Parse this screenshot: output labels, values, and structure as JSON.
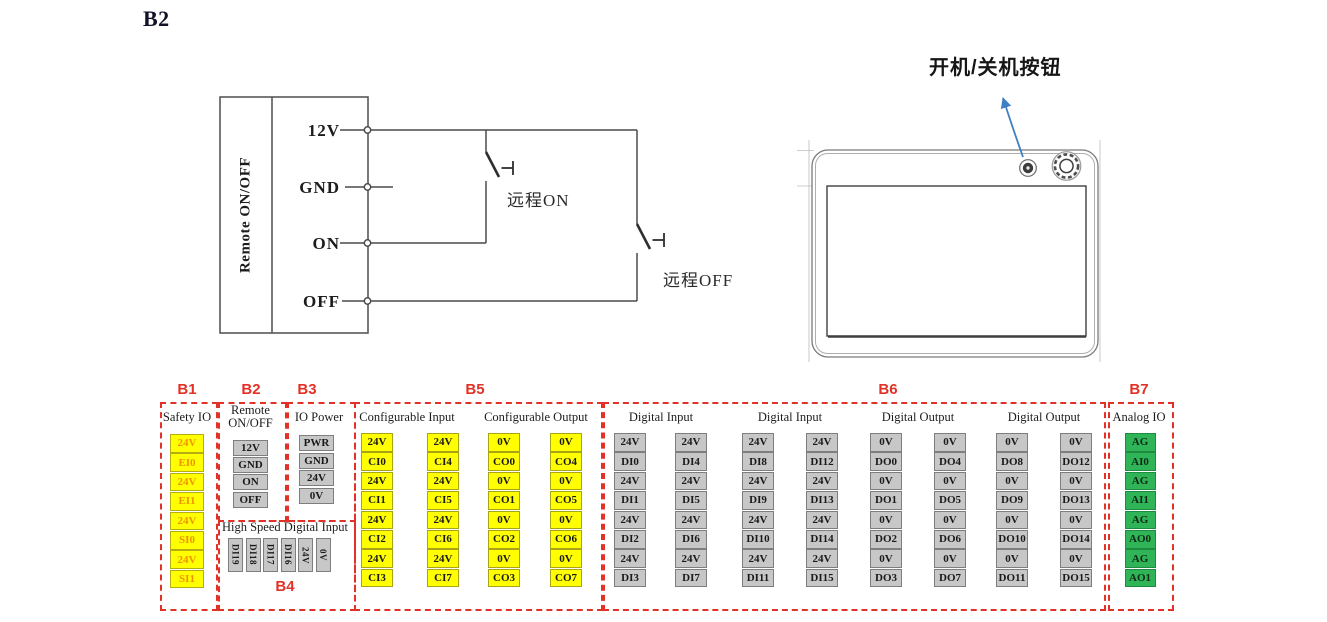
{
  "page": {
    "title": "B2"
  },
  "circuit": {
    "box_label": "Remote ON/OFF",
    "pins": [
      "12V",
      "GND",
      "ON",
      "OFF"
    ],
    "remote_on_label": "远程ON",
    "remote_off_label": "远程OFF"
  },
  "device": {
    "callout_label": "开机/关机按钮"
  },
  "colors": {
    "section_red": "#e23126",
    "terminal_yellow": "#ffff00",
    "safety_text_orange": "#ef9400",
    "terminal_gray": "#c7c7c7",
    "terminal_green": "#2fb457",
    "callout_arrow_blue": "#3f7fc4"
  },
  "terminal_sections": [
    {
      "id": "B1",
      "label": "B1",
      "style": "safety",
      "headers": [
        "Safety IO"
      ],
      "columns": [
        [
          "24V",
          "EI0",
          "24V",
          "EI1",
          "24V",
          "SI0",
          "24V",
          "SI1"
        ]
      ]
    },
    {
      "id": "B2",
      "label": "B2",
      "style": "gray",
      "headers": [
        "Remote ON/OFF"
      ],
      "columns": [
        [
          "12V",
          "GND",
          "ON",
          "OFF"
        ]
      ]
    },
    {
      "id": "B3",
      "label": "B3",
      "style": "gray",
      "headers": [
        "IO Power"
      ],
      "columns": [
        [
          "PWR",
          "GND",
          "24V",
          "0V"
        ]
      ]
    },
    {
      "id": "B4",
      "label": "B4",
      "style": "gray",
      "rotated": true,
      "headers": [
        "High Speed Digital Input"
      ],
      "columns": [
        [
          "DI19"
        ],
        [
          "DI18"
        ],
        [
          "DI17"
        ],
        [
          "DI16"
        ],
        [
          "24V"
        ],
        [
          "0V"
        ]
      ]
    },
    {
      "id": "B5",
      "label": "B5",
      "style": "yellow",
      "headers": [
        "Configurable Input",
        "Configurable Output"
      ],
      "columns": [
        [
          "24V",
          "CI0",
          "24V",
          "CI1",
          "24V",
          "CI2",
          "24V",
          "CI3"
        ],
        [
          "24V",
          "CI4",
          "24V",
          "CI5",
          "24V",
          "CI6",
          "24V",
          "CI7"
        ],
        [
          "0V",
          "CO0",
          "0V",
          "CO1",
          "0V",
          "CO2",
          "0V",
          "CO3"
        ],
        [
          "0V",
          "CO4",
          "0V",
          "CO5",
          "0V",
          "CO6",
          "0V",
          "CO7"
        ]
      ]
    },
    {
      "id": "B6",
      "label": "B6",
      "style": "gray",
      "headers": [
        "Digital Input",
        "Digital Input",
        "Digital Output",
        "Digital Output"
      ],
      "columns": [
        [
          "24V",
          "DI0",
          "24V",
          "DI1",
          "24V",
          "DI2",
          "24V",
          "DI3"
        ],
        [
          "24V",
          "DI4",
          "24V",
          "DI5",
          "24V",
          "DI6",
          "24V",
          "DI7"
        ],
        [
          "24V",
          "DI8",
          "24V",
          "DI9",
          "24V",
          "DI10",
          "24V",
          "DI11"
        ],
        [
          "24V",
          "DI12",
          "24V",
          "DI13",
          "24V",
          "DI14",
          "24V",
          "DI15"
        ],
        [
          "0V",
          "DO0",
          "0V",
          "DO1",
          "0V",
          "DO2",
          "0V",
          "DO3"
        ],
        [
          "0V",
          "DO4",
          "0V",
          "DO5",
          "0V",
          "DO6",
          "0V",
          "DO7"
        ],
        [
          "0V",
          "DO8",
          "0V",
          "DO9",
          "0V",
          "DO10",
          "0V",
          "DO11"
        ],
        [
          "0V",
          "DO12",
          "0V",
          "DO13",
          "0V",
          "DO14",
          "0V",
          "DO15"
        ]
      ]
    },
    {
      "id": "B7",
      "label": "B7",
      "style": "green",
      "headers": [
        "Analog IO"
      ],
      "columns": [
        [
          "AG",
          "AI0",
          "AG",
          "AI1",
          "AG",
          "AO0",
          "AG",
          "AO1"
        ]
      ]
    }
  ]
}
